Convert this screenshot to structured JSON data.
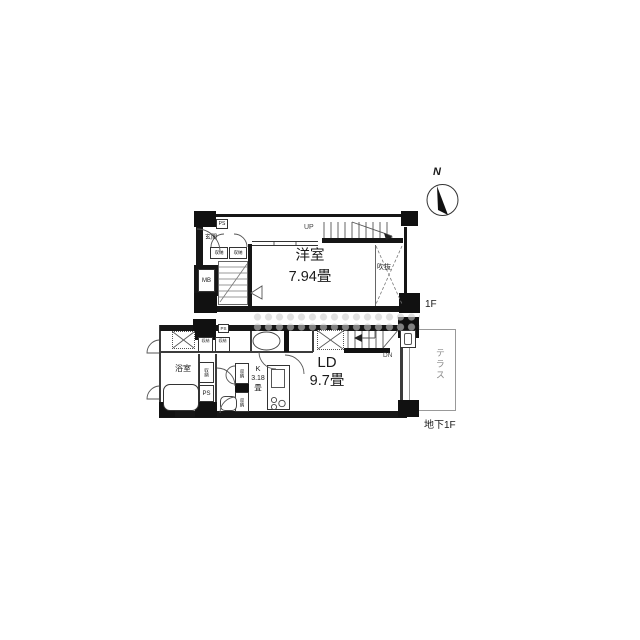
{
  "compass": {
    "north": "N"
  },
  "floor_1f": {
    "floor_label": "1F",
    "room": {
      "name": "洋室",
      "size": "7.94畳"
    },
    "stairs_label": "UP",
    "void_label": "吹抜",
    "entrance_label": "玄関",
    "storage_left": "収納",
    "storage_right": "収納",
    "pipe_space": "PS",
    "meter_box": "MB"
  },
  "floor_b1f": {
    "floor_label": "地下1F",
    "living": {
      "name": "LD",
      "size": "9.7畳"
    },
    "kitchen": {
      "name": "K",
      "size": "3.18",
      "unit": "畳"
    },
    "stairs_label": "DN",
    "terrace": "テラス",
    "bath": "浴室",
    "pipe_space": "PS",
    "pipe_space_top": "PS",
    "storage_bath": "収納",
    "storage_hall_upper": "収納",
    "storage_hall_lower": "収納",
    "cabinet_left": "収納",
    "cabinet_right": "収納"
  }
}
